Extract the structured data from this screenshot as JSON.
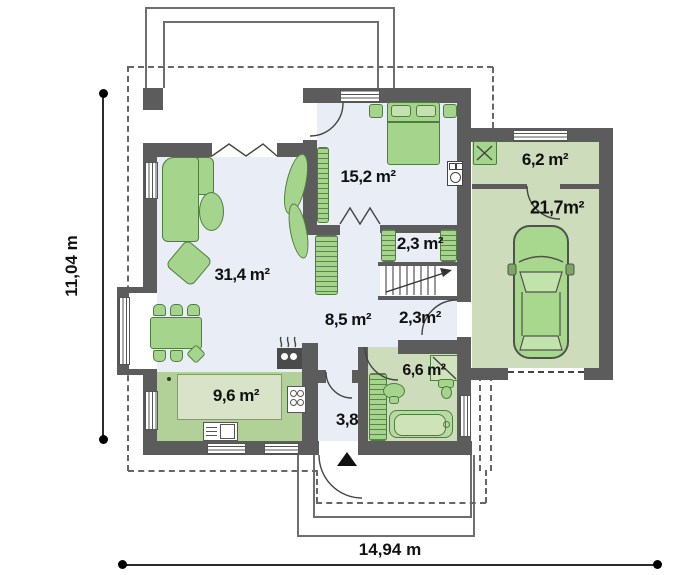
{
  "rooms": [
    {
      "id": "living-room",
      "label": "31,4 m²"
    },
    {
      "id": "bedroom",
      "label": "15,2 m²"
    },
    {
      "id": "closet",
      "label": "2,3 m²"
    },
    {
      "id": "hall",
      "label": "8,5 m²"
    },
    {
      "id": "corridor",
      "label": "2,3m²"
    },
    {
      "id": "bathroom",
      "label": "6,6 m²"
    },
    {
      "id": "vestibule",
      "label": "3,8"
    },
    {
      "id": "kitchen",
      "label": "9,6 m²"
    },
    {
      "id": "utility-room",
      "label": "6,2 m²"
    },
    {
      "id": "garage",
      "label": "21,7m²"
    }
  ],
  "dimensions": {
    "overall_width": "14,94 m",
    "overall_height": "11,04 m"
  },
  "colors": {
    "wall": "#5c5c5c",
    "floor_light": "#e9eef6",
    "floor_green": "#cddcba",
    "kitchen_counter": "#b2d199",
    "kitchen_inner": "#d8e3c8",
    "furniture": "#a5d48c",
    "furniture_border": "#4e7e3e",
    "text": "#111111"
  },
  "icons": [
    "bed",
    "nightstand",
    "wardrobe",
    "corner-sofa",
    "coffee-table",
    "armchair",
    "dining-table",
    "dining-chair",
    "plant",
    "stairs",
    "bathtub",
    "washbasin",
    "toilet",
    "shower",
    "kitchen-sink",
    "cooktop",
    "stove",
    "boiler",
    "chimney",
    "car",
    "boiler-fan",
    "entrance-arrow",
    "window",
    "door-swing",
    "folding-door"
  ]
}
